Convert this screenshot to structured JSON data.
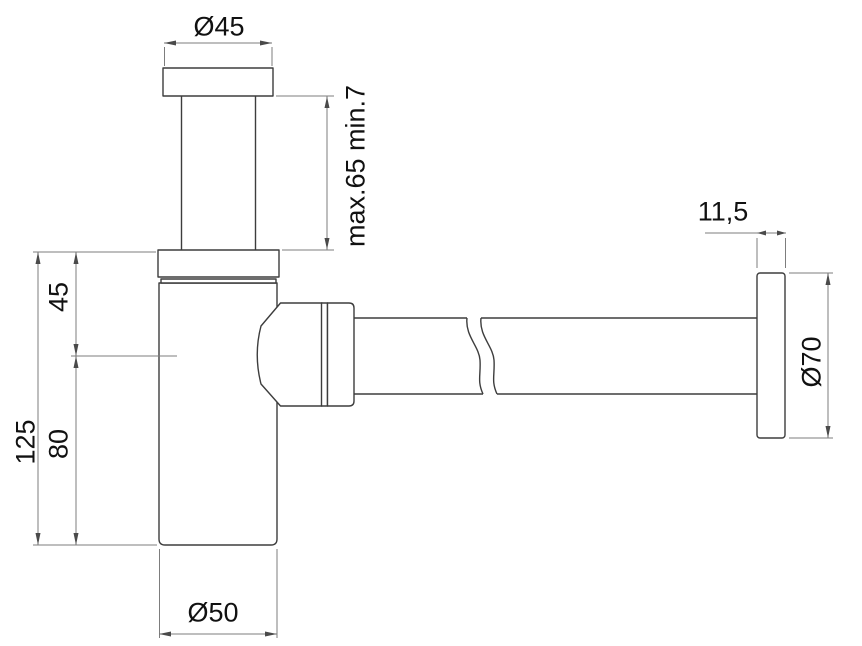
{
  "drawing": {
    "subject": "bottle-trap-siphon-dimension-drawing",
    "labels": {
      "top_diameter": "Ø45",
      "inlet_pipe_range": "max.65 min.7",
      "body_upper_height": "45",
      "body_lower_height": "80",
      "total_height": "125",
      "flange_thickness": "11,5",
      "flange_diameter": "Ø70",
      "body_diameter": "Ø50"
    },
    "colors": {
      "background": "#ffffff",
      "part_outline": "#3d3d3d",
      "dimension_line": "#7d7d7d",
      "arrow": "#4a4a4a",
      "text": "#111111"
    }
  }
}
